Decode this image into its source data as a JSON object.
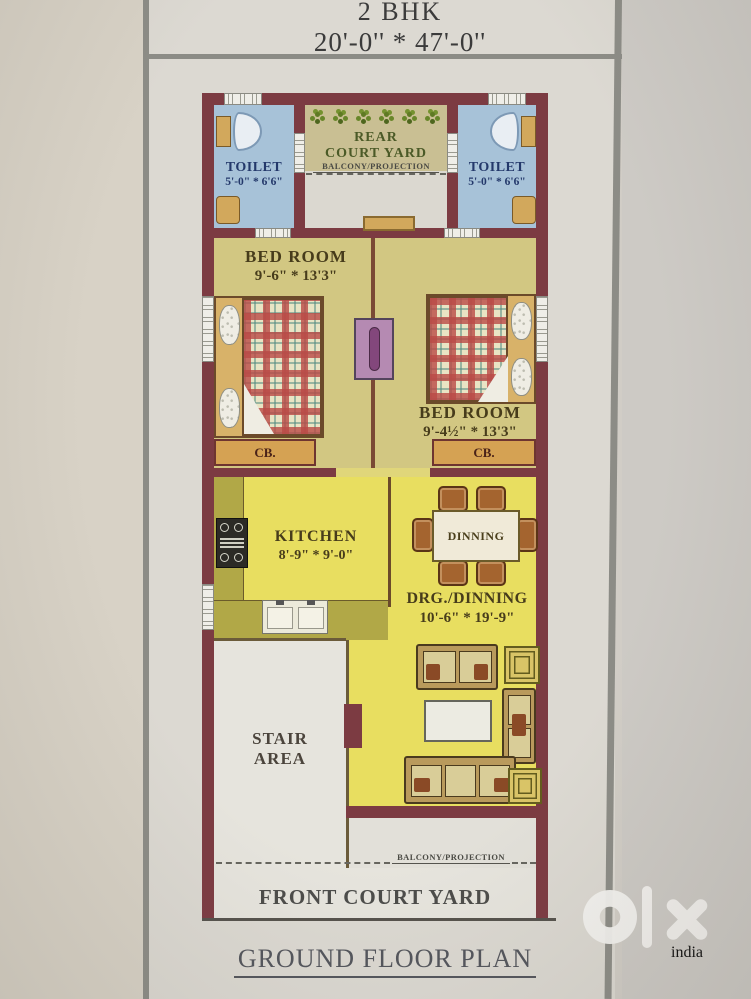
{
  "title": {
    "line1": "2 BHK",
    "line2": "20'-0'' * 47'-0''"
  },
  "plan": {
    "rear_court_yard": {
      "label_line1": "REAR",
      "label_line2": "COURT YARD"
    },
    "balcony_projection_label": "BALCONY/PROJECTION",
    "toilet": {
      "label": "TOILET",
      "size": "5'-0\" * 6'6\""
    },
    "bedroom_left": {
      "name": "BED ROOM",
      "size": "9'-6\" * 13'3\""
    },
    "bedroom_right": {
      "name": "BED ROOM",
      "size": "9'-4½\" * 13'3\""
    },
    "cupboard_label": "CB.",
    "kitchen": {
      "name": "KITCHEN",
      "size": "8'-9\" * 9'-0\""
    },
    "dining_table_label": "DINNING",
    "drg_dining": {
      "name": "DRG./DINNING",
      "size": "10'-6\" * 19'-9\""
    },
    "stair_area": {
      "line1": "STAIR",
      "line2": "AREA"
    },
    "front_court_yard": "FRONT COURT YARD"
  },
  "footer": {
    "caption": "GROUND FLOOR PLAN"
  },
  "watermark": {
    "brand": "olx",
    "sub": "india"
  },
  "colors": {
    "wall": "#7c3b42",
    "toilet_floor": "#a7c2d8",
    "courtyard_khaki": "#c9bf93",
    "bedroom_floor": "#d2c782",
    "hall_yellow": "#e8de60",
    "counter_olive": "#b1a847",
    "cupboard_fill": "#d5a253",
    "door_purple": "#83477c",
    "label_dark": "#473c1b",
    "toilet_text_navy": "#24396b",
    "courtyard_text_green": "#4b5a27",
    "paper": "#dcd9d2",
    "photo_background": "#d1cdc6"
  }
}
